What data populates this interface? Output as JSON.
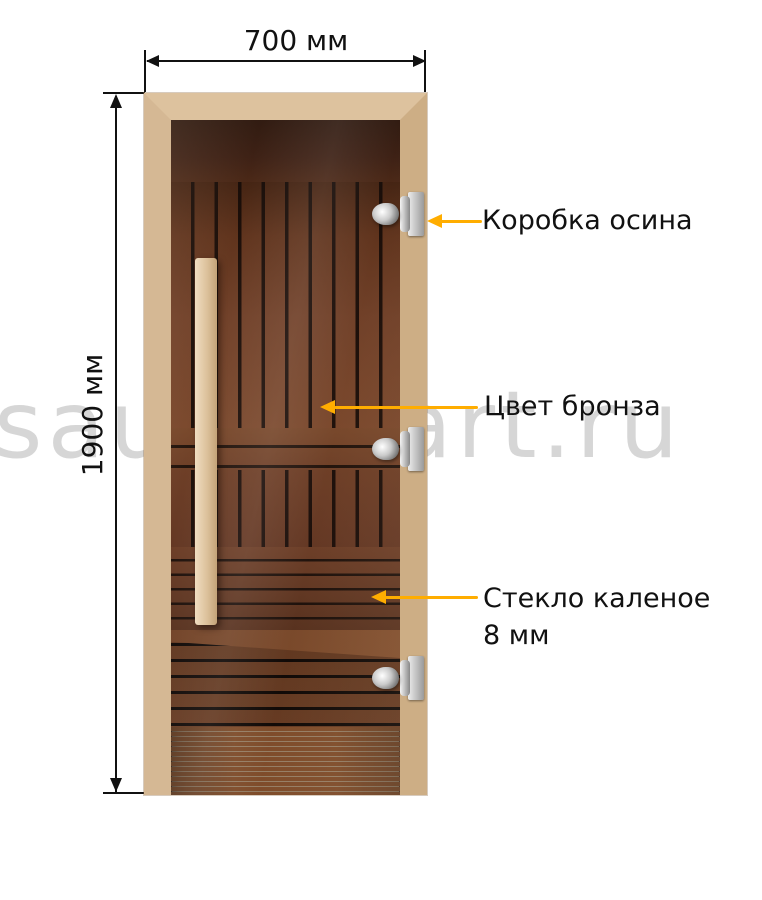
{
  "diagram": {
    "width_dimension": "700 мм",
    "height_dimension": "1900 мм",
    "callouts": [
      {
        "label": "Коробка осина"
      },
      {
        "label": "Цвет бронза"
      },
      {
        "label": "Стекло каленое",
        "label_line2": "8 мм"
      }
    ],
    "watermark": "saunamart.ru",
    "colors": {
      "callout_arrow": "#ffad00",
      "dimension_line": "#111111",
      "frame_wood": "#d5b894",
      "interior_wood": "#6e3d25",
      "glass_tint_dark": "#351c12",
      "handle_wood": "#e3cba6",
      "hinge_metal": "#c9c9c9",
      "watermark_gray": "#cdcdcd",
      "background": "#ffffff"
    }
  }
}
